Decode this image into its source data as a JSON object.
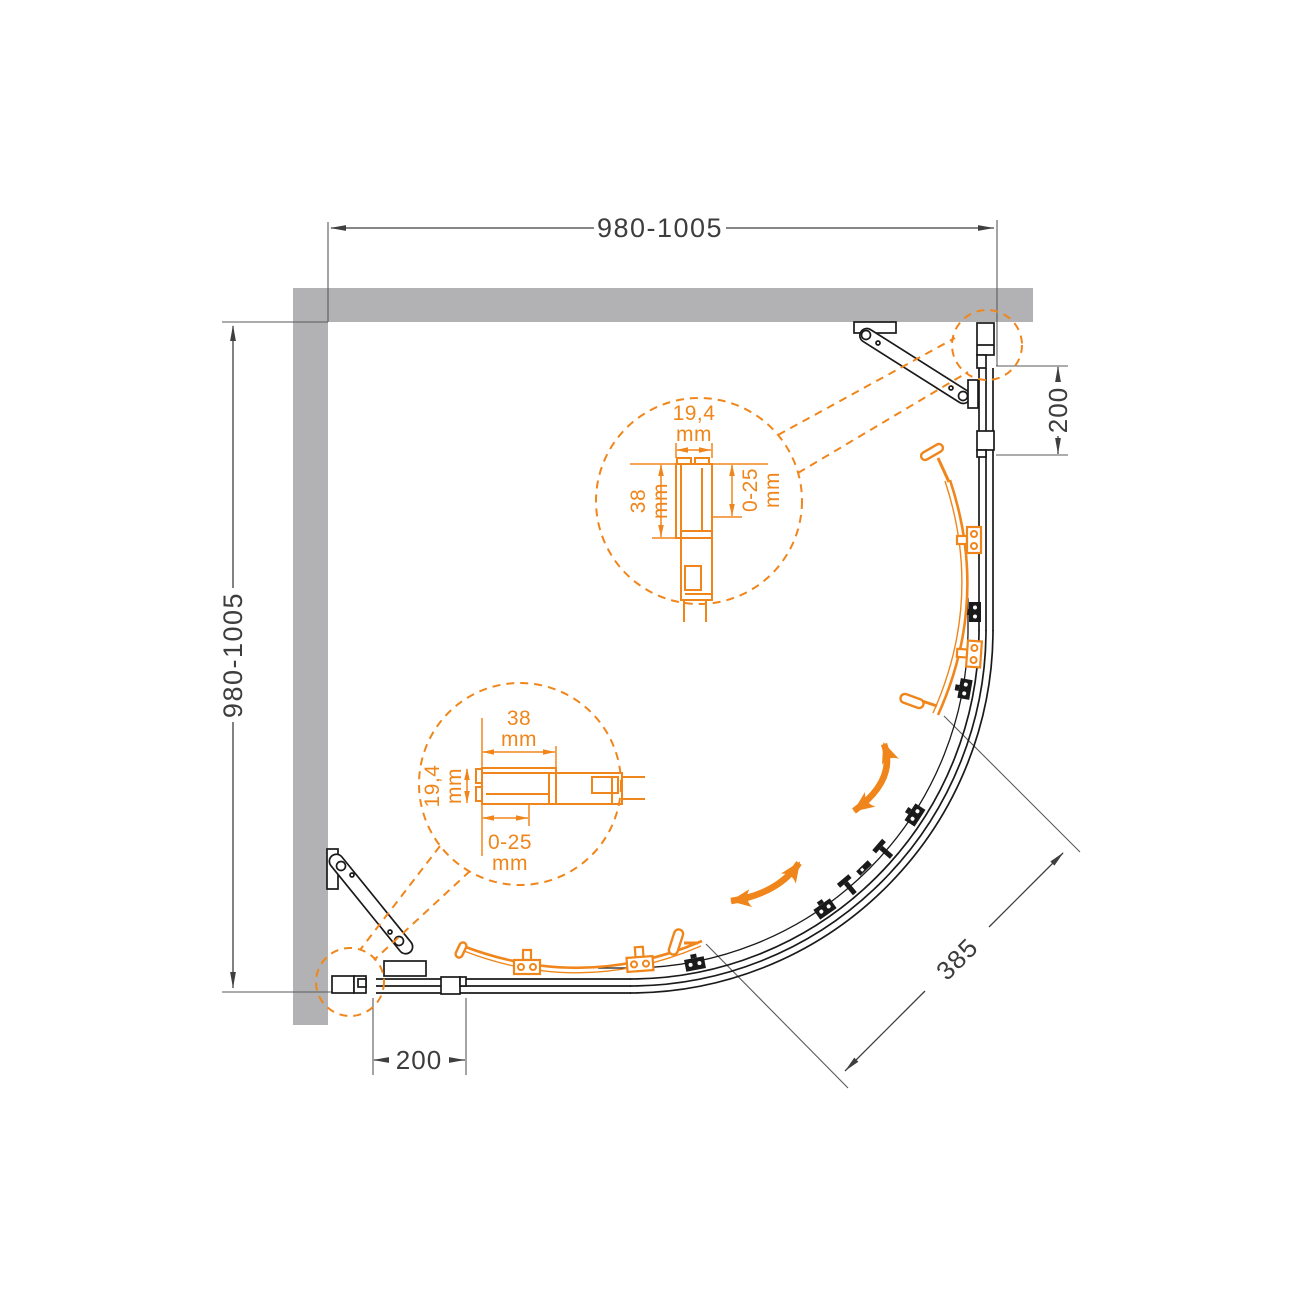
{
  "drawing": {
    "dimensions": {
      "top_width": {
        "value": "980-1005"
      },
      "left_depth": {
        "value": "980-1005"
      },
      "right_fixed_section": {
        "value": "200"
      },
      "bottom_fixed_section": {
        "value": "200"
      },
      "door_opening_diagonal": {
        "value": "385"
      }
    },
    "detail_callout_top": {
      "profile_width": {
        "value": "19,4",
        "unit": "mm"
      },
      "profile_depth": {
        "value": "38",
        "unit": "mm"
      },
      "adjustment_range": {
        "value": "0-25",
        "unit": "mm"
      }
    },
    "detail_callout_bottom": {
      "profile_depth": {
        "value": "38",
        "unit": "mm"
      },
      "profile_width": {
        "value": "19,4",
        "unit": "mm"
      },
      "adjustment_range": {
        "value": "0-25",
        "unit": "mm"
      }
    },
    "colors": {
      "accent_orange": "#F0861B",
      "wall_gray": "#B2B2B4",
      "line_black": "#1A1A1A",
      "dimension_gray": "#3F3F3F"
    }
  }
}
